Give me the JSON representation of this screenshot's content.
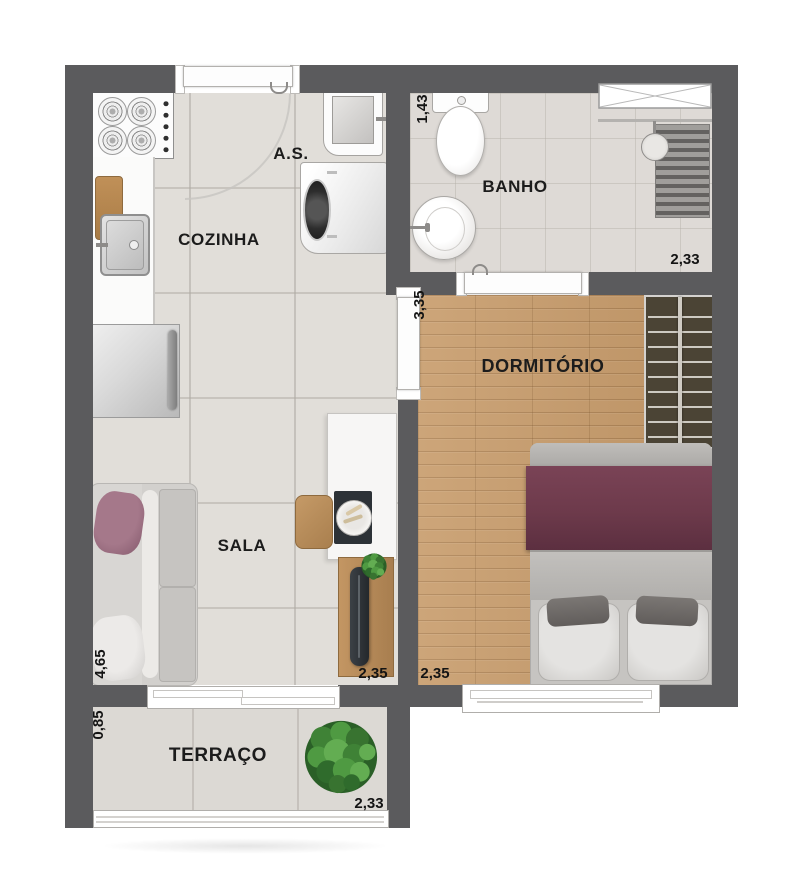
{
  "plan_title": "apartment-floor-plan",
  "rooms": {
    "cozinha": {
      "label": "COZINHA"
    },
    "area_servico": {
      "label": "A.S."
    },
    "banho": {
      "label": "BANHO"
    },
    "dormitorio": {
      "label": "DORMITÓRIO"
    },
    "sala": {
      "label": "SALA"
    },
    "terraco": {
      "label": "TERRAÇO"
    }
  },
  "dimensions": {
    "area_servico_depth": "1,43",
    "banho_width": "2,33",
    "dormitorio_depth": "3,35",
    "dormitorio_width": "2,35",
    "sala_width": "2,35",
    "sala_depth": "4,65",
    "terraco_depth": "0,85",
    "terraco_width": "2,33"
  },
  "colors": {
    "wall": "#5b5b5d",
    "tile_floor": "#e1ded9",
    "bath_floor": "#dedad6",
    "wood_floor": "#c79b6a",
    "terrace_floor": "#dcd9d4",
    "bed_cover": "#6d3a4b",
    "sofa_pillow": "#a5788a",
    "wardrobe": "#4b4435",
    "plant": "#4e8f45",
    "label_text": "#1c1c1c"
  }
}
